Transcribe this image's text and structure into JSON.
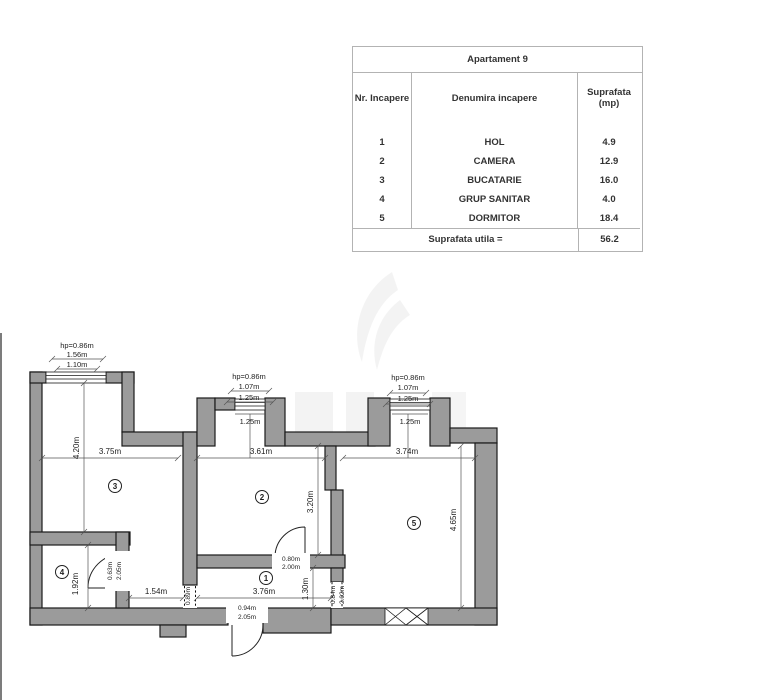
{
  "colors": {
    "wall_fill": "#9b9b9b",
    "wall_stroke": "#1a1a1a",
    "table_border": "#b3b3b3",
    "text": "#222222"
  },
  "table": {
    "title": "Apartament 9",
    "columns": {
      "nr": "Nr. Incapere",
      "name": "Denumira incapere",
      "area1": "Suprafata",
      "area2": "(mp)"
    },
    "rows": [
      {
        "nr": "1",
        "name": "HOL",
        "area": "4.9"
      },
      {
        "nr": "2",
        "name": "CAMERA",
        "area": "12.9"
      },
      {
        "nr": "3",
        "name": "BUCATARIE",
        "area": "16.0"
      },
      {
        "nr": "4",
        "name": "GRUP SANITAR",
        "area": "4.0"
      },
      {
        "nr": "5",
        "name": "DORMITOR",
        "area": "18.4"
      }
    ],
    "footer": {
      "label": "Suprafata utila =",
      "value": "56.2"
    }
  },
  "plan": {
    "labels": {
      "r1": "1",
      "r2": "2",
      "r3": "3",
      "r4": "4",
      "r5": "5"
    },
    "win3": {
      "hp": "hp=0.86m",
      "w1": "1.56m",
      "w2": "1.10m"
    },
    "win2": {
      "hp": "hp=0.86m",
      "w1": "1.07m",
      "w2": "1.25m",
      "sill": "1.25m"
    },
    "win5": {
      "hp": "hp=0.86m",
      "w1": "1.07m",
      "w2": "1.25m",
      "sill": "1.25m"
    },
    "dim": {
      "r3w": "3.75m",
      "r3h": "4.20m",
      "r2w": "3.61m",
      "r2h": "3.20m",
      "r5w": "3.74m",
      "r5h": "4.65m",
      "r4h": "1.92m",
      "hall_seg": "1.54m",
      "hall_w": "3.76m",
      "hall_h": "1.30m",
      "pass": "0.89m"
    },
    "door_bath": {
      "w": "0.63m",
      "h": "2.05m"
    },
    "door_room2": {
      "w": "0.80m",
      "h": "2.00m"
    },
    "door_room5": {
      "w": "0.84m",
      "h": "2.02m"
    },
    "door_entry": {
      "w": "0.94m",
      "h": "2.05m"
    }
  }
}
